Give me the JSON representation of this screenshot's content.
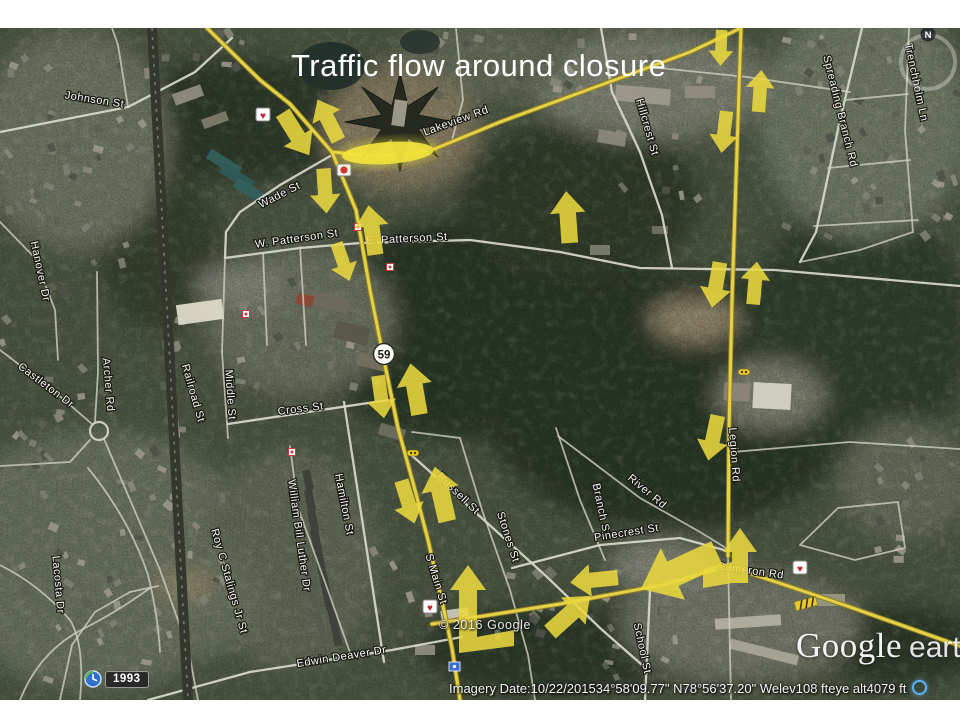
{
  "slide": {
    "title": "Traffic flow around closure"
  },
  "map": {
    "route_shield": "59",
    "compass_label": "N",
    "history_badge": "1993",
    "copyright": "© 2016 Google",
    "logo": {
      "google": "Google",
      "earth": "earth"
    },
    "status_bar": {
      "imagery_label": "Imagery Date:",
      "imagery_date": "10/22/2015",
      "latitude": "34°58'09.77\" N",
      "longitude": "78°56'37.20\" W",
      "elev_label": "elev",
      "elevation": "108 ft",
      "eye_alt_label": "eye alt",
      "eye_altitude": "4079 ft"
    },
    "closure_highlight": {
      "cx": 388,
      "cy": 153,
      "rx": 46,
      "ry": 11,
      "rot": -4
    },
    "street_labels": [
      {
        "text": "Johnson St",
        "x": 94,
        "y": 103,
        "r": 9,
        "s": 11
      },
      {
        "text": "Hanover Dr",
        "x": 37,
        "y": 272,
        "r": 78,
        "s": 11
      },
      {
        "text": "Castleton Dr",
        "x": 44,
        "y": 388,
        "r": 37,
        "s": 11
      },
      {
        "text": "Archer Rd",
        "x": 105,
        "y": 385,
        "r": 85,
        "s": 11
      },
      {
        "text": "Lacosta Dr",
        "x": 55,
        "y": 585,
        "r": 85,
        "s": 11
      },
      {
        "text": "Roy C Stalings Jr St",
        "x": 226,
        "y": 582,
        "r": 74,
        "s": 11
      },
      {
        "text": "William Bill Luther Dr",
        "x": 296,
        "y": 536,
        "r": 82,
        "s": 11
      },
      {
        "text": "Hamilton St",
        "x": 341,
        "y": 505,
        "r": 79,
        "s": 11
      },
      {
        "text": "Middle St",
        "x": 227,
        "y": 395,
        "r": 86,
        "s": 11
      },
      {
        "text": "Railroad St",
        "x": 190,
        "y": 394,
        "r": 74,
        "s": 11
      },
      {
        "text": "Cross St",
        "x": 301,
        "y": 412,
        "r": -7,
        "s": 11
      },
      {
        "text": "W. Patterson St",
        "x": 297,
        "y": 242,
        "r": -8,
        "s": 11
      },
      {
        "text": "E. Patterson St",
        "x": 407,
        "y": 242,
        "r": -3,
        "s": 11
      },
      {
        "text": "Wade St",
        "x": 281,
        "y": 198,
        "r": -27,
        "s": 11
      },
      {
        "text": "Lakeview Rd",
        "x": 457,
        "y": 124,
        "r": -20,
        "s": 11
      },
      {
        "text": "Hillcrest St",
        "x": 644,
        "y": 128,
        "r": 74,
        "s": 11
      },
      {
        "text": "Spreading Branch Rd",
        "x": 837,
        "y": 112,
        "r": 76,
        "s": 11
      },
      {
        "text": "Trenchholm Ln",
        "x": 913,
        "y": 83,
        "r": 78,
        "s": 11
      },
      {
        "text": "Legion Rd",
        "x": 731,
        "y": 455,
        "r": 86,
        "s": 11
      },
      {
        "text": "Russell St",
        "x": 456,
        "y": 496,
        "r": 44,
        "s": 11
      },
      {
        "text": "Stones St",
        "x": 505,
        "y": 538,
        "r": 72,
        "s": 11
      },
      {
        "text": "Branch St",
        "x": 598,
        "y": 510,
        "r": 78,
        "s": 11
      },
      {
        "text": "River Rd",
        "x": 645,
        "y": 494,
        "r": 40,
        "s": 11
      },
      {
        "text": "Pinecrest St",
        "x": 627,
        "y": 536,
        "r": -9,
        "s": 11
      },
      {
        "text": "Cameron Rd",
        "x": 750,
        "y": 574,
        "r": 8,
        "s": 11
      },
      {
        "text": "S Main St",
        "x": 433,
        "y": 580,
        "r": 73,
        "s": 11
      },
      {
        "text": "School St",
        "x": 639,
        "y": 649,
        "r": 78,
        "s": 11
      },
      {
        "text": "Edwin Deaver Dr",
        "x": 342,
        "y": 660,
        "r": -9,
        "s": 11
      }
    ],
    "flow_arrows": [
      {
        "x": 296,
        "y": 134,
        "r": 148,
        "l": 50
      },
      {
        "x": 328,
        "y": 120,
        "r": -27,
        "l": 46
      },
      {
        "x": 325,
        "y": 191,
        "r": 176,
        "l": 45
      },
      {
        "x": 372,
        "y": 230,
        "r": -8,
        "l": 50
      },
      {
        "x": 343,
        "y": 262,
        "r": 161,
        "l": 40
      },
      {
        "x": 568,
        "y": 217,
        "r": -4,
        "l": 52
      },
      {
        "x": 415,
        "y": 389,
        "r": -10,
        "l": 52
      },
      {
        "x": 381,
        "y": 397,
        "r": 172,
        "l": 43
      },
      {
        "x": 408,
        "y": 502,
        "r": 163,
        "l": 45
      },
      {
        "x": 441,
        "y": 494,
        "r": -13,
        "l": 56
      },
      {
        "x": 570,
        "y": 614,
        "r": 48,
        "l": 54
      },
      {
        "x": 594,
        "y": 580,
        "r": -96,
        "l": 48
      },
      {
        "x": 679,
        "y": 571,
        "r": -115,
        "l": 84
      },
      {
        "x": 721,
        "y": 48,
        "r": 182,
        "l": 36
      },
      {
        "x": 760,
        "y": 91,
        "r": 4,
        "l": 42
      },
      {
        "x": 724,
        "y": 132,
        "r": 187,
        "l": 42
      },
      {
        "x": 716,
        "y": 285,
        "r": 190,
        "l": 46
      },
      {
        "x": 755,
        "y": 283,
        "r": 5,
        "l": 43
      },
      {
        "x": 713,
        "y": 438,
        "r": 192,
        "l": 46
      }
    ],
    "bent_arrows": [
      {
        "points": "468,565 450,590 459,590 459,653 514,646 514,630 477,637 477,590 486,590"
      },
      {
        "points": "740,528 723,552 732,552 732,562 703,569 703,588 732,583 748,583 748,552 757,552"
      }
    ]
  }
}
